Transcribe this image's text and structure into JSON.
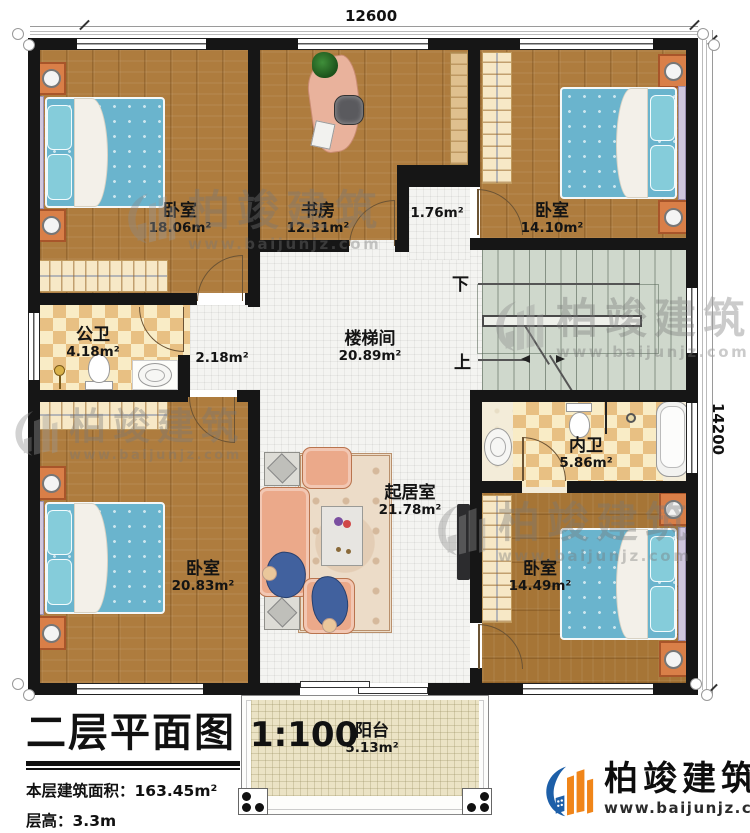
{
  "dimensions": {
    "width": "12600",
    "height": "14200"
  },
  "title_block": {
    "title": "二层平面图",
    "scale": "1:100",
    "area_label": "本层建筑面积：",
    "area_value": "163.45m²",
    "height_label": "层高：",
    "height_value": "3.3m"
  },
  "logo": {
    "name": "柏竣建筑",
    "url": "www.baijunjz.com"
  },
  "watermark": {
    "name": "柏竣建筑",
    "url": "www.baijunjz.com"
  },
  "stairs": {
    "down": "下",
    "up": "上"
  },
  "rooms": [
    {
      "id": "bedroom-tl",
      "name": "卧室",
      "area": "18.06m²"
    },
    {
      "id": "study",
      "name": "书房",
      "area": "12.31m²"
    },
    {
      "id": "vestibule",
      "name": "",
      "area": "1.76m²"
    },
    {
      "id": "bedroom-tr",
      "name": "卧室",
      "area": "14.10m²"
    },
    {
      "id": "public-bath",
      "name": "公卫",
      "area": "4.18m²"
    },
    {
      "id": "hallway",
      "name": "",
      "area": "2.18m²"
    },
    {
      "id": "stair-hall",
      "name": "楼梯间",
      "area": "20.89m²"
    },
    {
      "id": "ensuite-bath",
      "name": "内卫",
      "area": "5.86m²"
    },
    {
      "id": "bedroom-bl",
      "name": "卧室",
      "area": "20.83m²"
    },
    {
      "id": "living-room",
      "name": "起居室",
      "area": "21.78m²"
    },
    {
      "id": "bedroom-br",
      "name": "卧室",
      "area": "14.49m²"
    },
    {
      "id": "balcony",
      "name": "阳台",
      "area": "5.13m²"
    }
  ],
  "colors": {
    "wall": "#161616",
    "wood_floor": "#ae7c3e",
    "tile_floor": "#f4f4f1",
    "checker_tile": "#e8c083",
    "stair_floor": "#cfd8cc",
    "balcony_floor": "#ebe3c5",
    "bed_blue": "#6ab4cd",
    "furniture_orange": "#d97f48",
    "sofa_salmon": "#eba98a",
    "logo_blue": "#1d5fa8",
    "logo_orange": "#f08519"
  }
}
